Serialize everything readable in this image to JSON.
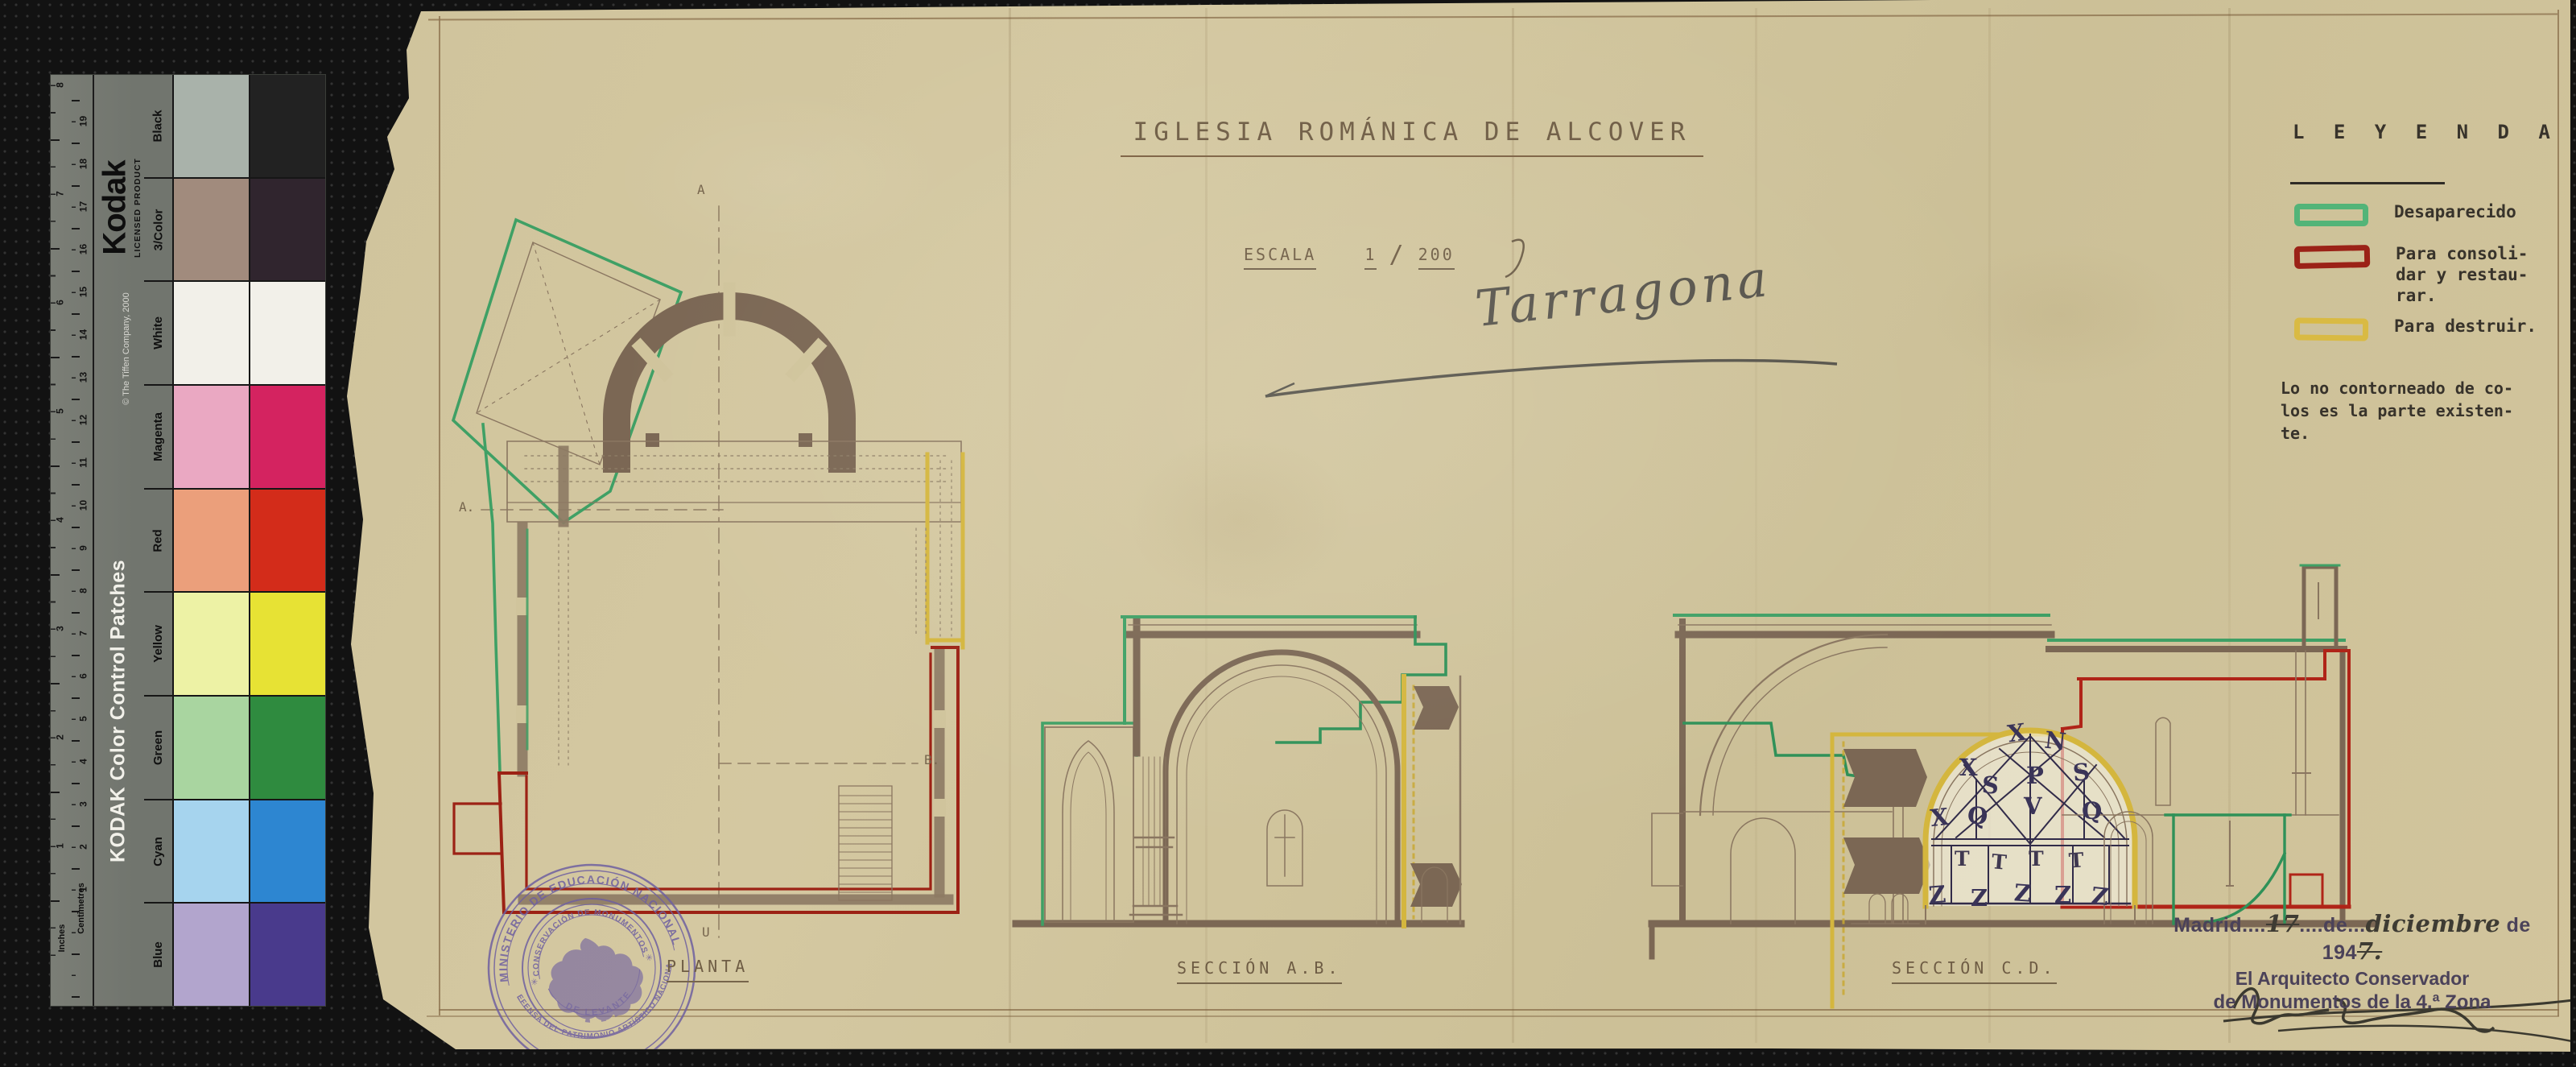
{
  "kodak": {
    "brand": "Kodak",
    "licensed": "LICENSED PRODUCT",
    "copyright": "© The Tiffen Company, 2000",
    "product": "KODAK Color Control Patches",
    "centimetres": "Centimetres",
    "inches": "Inches",
    "cm_numbers": [
      "19",
      "18",
      "17",
      "16",
      "15",
      "14",
      "13",
      "12",
      "11",
      "10",
      "9",
      "8",
      "7",
      "6",
      "5",
      "4",
      "3",
      "2",
      "1"
    ],
    "inch_numbers": [
      "8",
      "7",
      "6",
      "5",
      "4",
      "3",
      "2",
      "1"
    ],
    "rows": [
      {
        "label": "Black",
        "light": "#a9b2aa",
        "full": "#222222"
      },
      {
        "label": "3/Color",
        "light": "#a18b7d",
        "full": "#30252e"
      },
      {
        "label": "White",
        "light": "#f2f0e9",
        "full": "#f2f0e9"
      },
      {
        "label": "Magenta",
        "light": "#eaa8c2",
        "full": "#d42360"
      },
      {
        "label": "Red",
        "light": "#eb9f7b",
        "full": "#d32c1a"
      },
      {
        "label": "Yellow",
        "light": "#edf2a5",
        "full": "#e7e234"
      },
      {
        "label": "Green",
        "light": "#a9d5a0",
        "full": "#2f8b3f"
      },
      {
        "label": "Cyan",
        "light": "#a6d4ee",
        "full": "#2d86d1"
      },
      {
        "label": "Blue",
        "light": "#b2a5cd",
        "full": "#493a8c"
      }
    ]
  },
  "sheet": {
    "title": "IGLESIA ROMÁNICA DE ALCOVER",
    "escala": {
      "label": "ESCALA",
      "num": "1",
      "slash": "/",
      "den": "200"
    },
    "province": "Tarragona",
    "legend": {
      "heading": "L E Y E N D A",
      "items": [
        {
          "color": "#53b478",
          "label": "Desaparecido"
        },
        {
          "color": "#9b2217",
          "label": "Para consoli-\ndar y restau-\nrar."
        },
        {
          "color": "#d9ba43",
          "label": "Para destruir."
        }
      ],
      "note": "Lo no contorneado de co-\nlos es la parte existen-\nte."
    },
    "captions": {
      "plan": "PLANTA",
      "section_ab": "SECCIÓN  A.B.",
      "section_cd": "SECCIÓN   C.D."
    },
    "marks": {
      "plan_top": "A",
      "plan_left": "A.",
      "plan_right": "B.",
      "plan_bottom": "U"
    },
    "truss": {
      "letters": [
        "X",
        "N",
        "X",
        "S",
        "P",
        "S",
        "V",
        "Q",
        "Q",
        "X"
      ],
      "t_row": [
        "T",
        "T",
        "T",
        "T"
      ],
      "z_row": [
        "Z",
        "Z",
        "Z",
        "Z",
        "Z"
      ]
    },
    "stamp": {
      "ring_top": "MINISTERIO DE EDUCACIÓN NACIONAL",
      "ring_bottom": "DEFENSA DEL PATRIMONIO ARTÍSTICO NACIONAL",
      "inner_top": "CONSERVACIÓN DE MONUMENTOS",
      "inner_bottom": "DE LEVANTE",
      "star_left": "✳",
      "star_right": "✳"
    },
    "dated": {
      "city": "Madrid",
      "dots1": "....",
      "day": "17",
      "de1": "de",
      "dots2": "...",
      "month": "diciembre",
      "de2": "de 194",
      "year": "7.",
      "line2": "El Arquitecto Conservador",
      "line3": "de Monumentos de la 4.ª Zona"
    }
  }
}
